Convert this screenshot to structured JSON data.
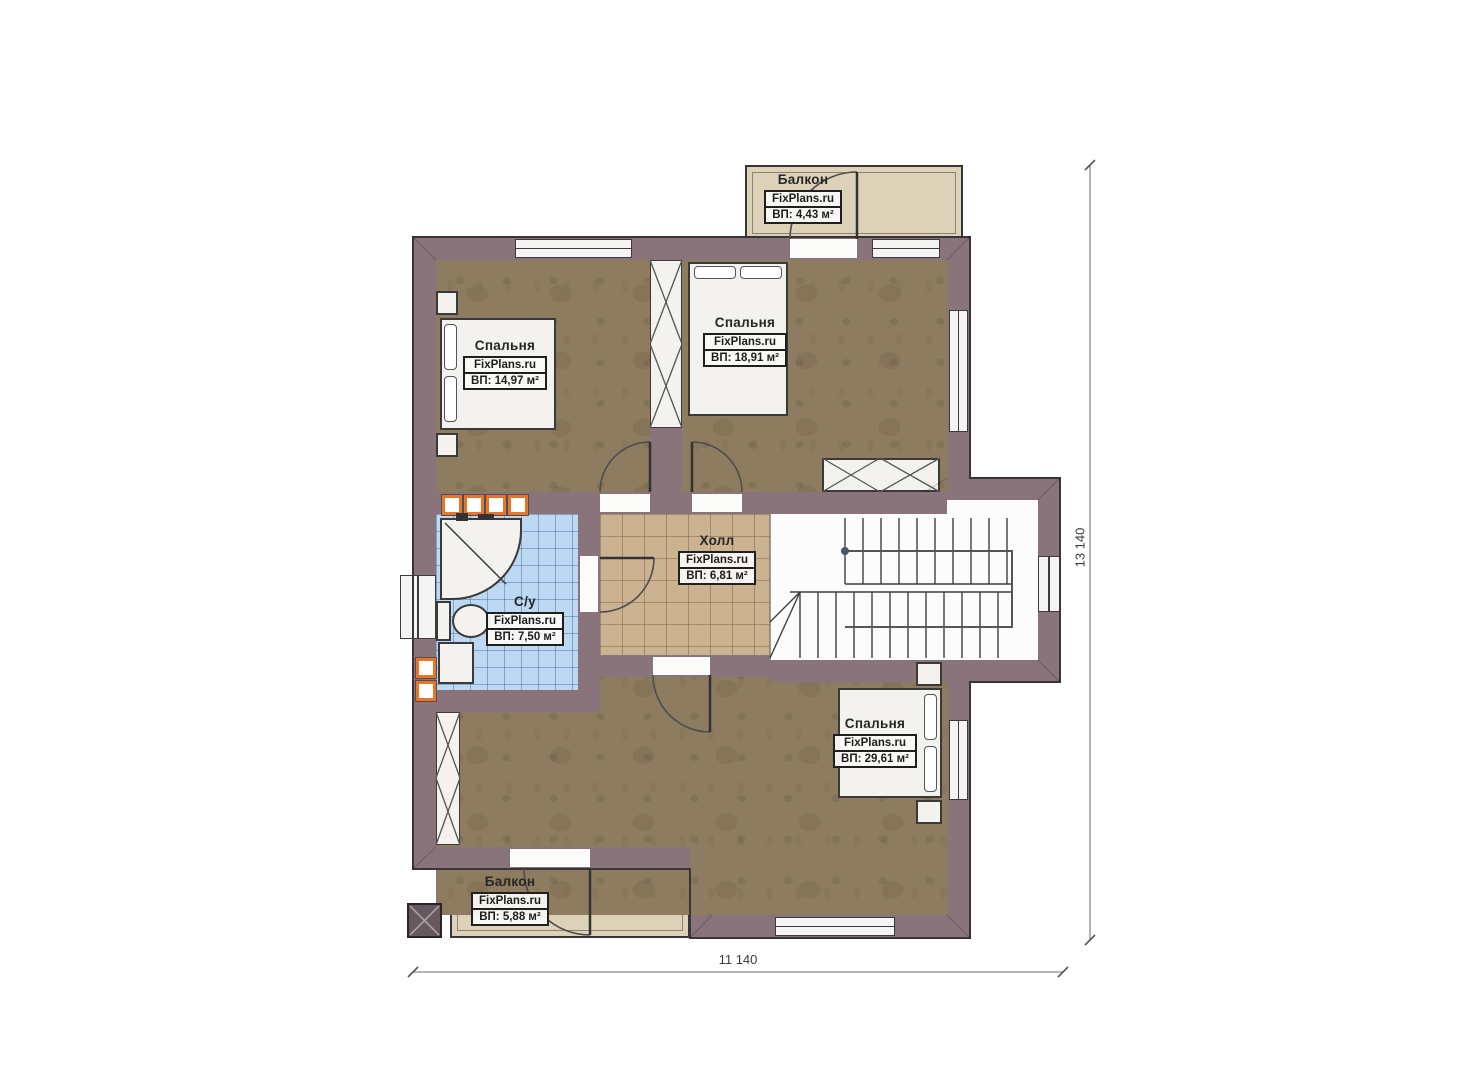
{
  "plan_title": "floor-plan-second-level",
  "rooms": {
    "balcony_top": {
      "name": "Балкон",
      "brand": "FixPlans.ru",
      "area": "ВП: 4,43 м²"
    },
    "bedroom1": {
      "name": "Спальня",
      "brand": "FixPlans.ru",
      "area": "ВП: 14,97 м²"
    },
    "bedroom2": {
      "name": "Спальня",
      "brand": "FixPlans.ru",
      "area": "ВП: 18,91 м²"
    },
    "hall": {
      "name": "Холл",
      "brand": "FixPlans.ru",
      "area": "ВП: 6,81 м²"
    },
    "bathroom": {
      "name": "С/у",
      "brand": "FixPlans.ru",
      "area": "ВП: 7,50 м²"
    },
    "bedroom3": {
      "name": "Спальня",
      "brand": "FixPlans.ru",
      "area": "ВП: 29,61 м²"
    },
    "balcony_bottom": {
      "name": "Балкон",
      "brand": "FixPlans.ru",
      "area": "ВП: 5,88 м²"
    }
  },
  "dimensions": {
    "width": "11 140",
    "height": "13 140"
  },
  "colors": {
    "wall": "#8a747b",
    "wood": "#8d7c5f",
    "tile_hall": "#cbb391",
    "tile_bath": "#bcd8f2",
    "balcony": "#ddd2b8",
    "accent": "#e8762a",
    "outline": "#3a333a"
  }
}
